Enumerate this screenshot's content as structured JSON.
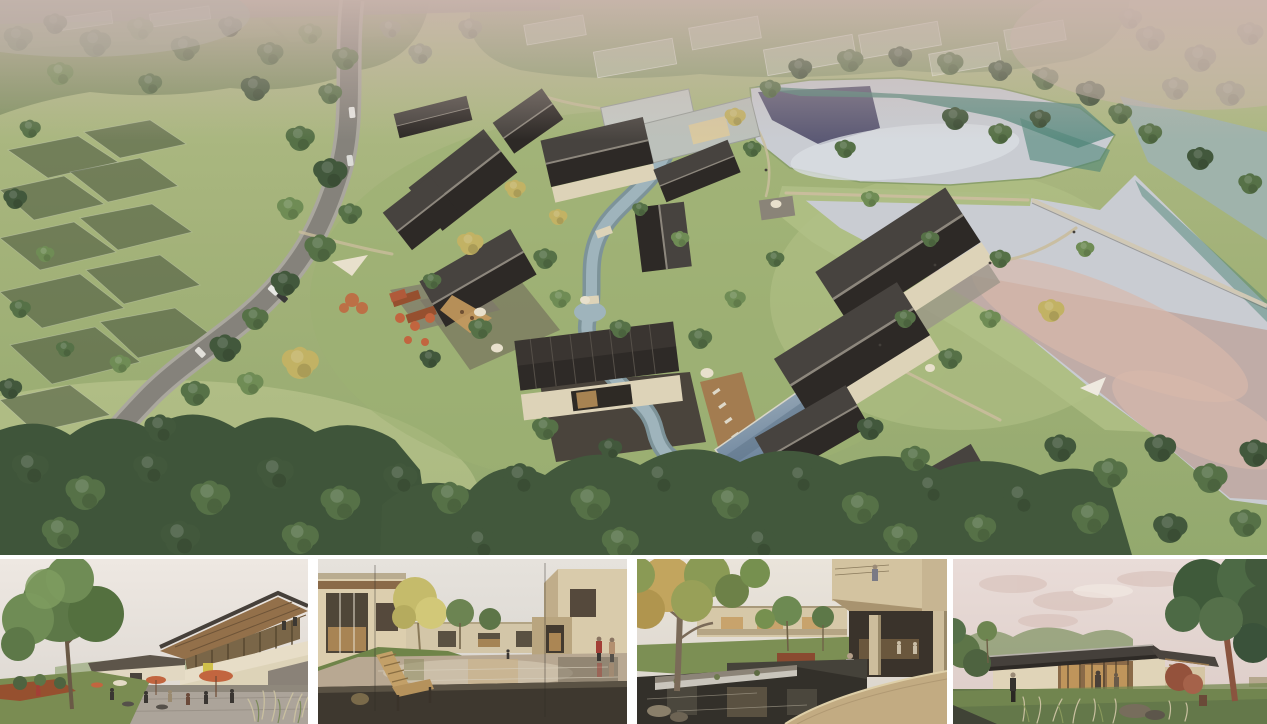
{
  "board": {
    "hero": {
      "name": "aerial-masterplan-view",
      "label": "Aerial rendering of a village resort masterplan: dark-roofed courtyard houses around a winding stream, country road and shaded orchards on the left, chain of fish ponds with walking dikes on the right"
    },
    "thumbnails": [
      {
        "name": "plaza-cafe-view",
        "label": "Eye-level rendering of a plaza cafe with orange umbrellas under a two-storey timber-soffit building and a large tree"
      },
      {
        "name": "reflecting-pond-view",
        "label": "Eye-level rendering of a courtyard reflecting pond with a wooden lounge bench and cream buildings"
      },
      {
        "name": "garden-waterfall-view",
        "label": "Eye-level rendering of a garden courtyard with dark pond, stone weir waterfall and cantilevered balcony"
      },
      {
        "name": "lakeside-pavilion-view",
        "label": "Eye-level dusk rendering of a single-storey glass pavilion with dark metal roof beside a large tree"
      }
    ],
    "palette": {
      "grassBase": "#a8b77d",
      "grassLight": "#c0ca96",
      "grassDark": "#7f9a5e",
      "lawn": "#9db36f",
      "treeDark": "#42583c",
      "treeMid": "#567147",
      "treeLight": "#6f8c55",
      "treeYellow": "#c2b264",
      "treeHazy": "#8a9579",
      "roofDark": "#3a3531",
      "roofLight": "#c3c7c2",
      "wallCream": "#ddd3b8",
      "road": "#85827b",
      "roadEdge": "#aaa79e",
      "waterSilver": "#c9ccd2",
      "waterTeal": "#4f8578",
      "waterNavy": "#413d5e",
      "waterMauve": "#bfa8a2",
      "waterPink": "#d8b9ab",
      "stream": "#9fb4bc",
      "pool": "#7e93a6",
      "deckWood": "#a37c50",
      "stonePaving": "#4a443c",
      "pathBeige": "#c9bd9c",
      "haze": "#cbb6ae",
      "netCanopy": "#3c4733",
      "skyWarm": "#ece6df",
      "skyDusk": "#e8dcd8",
      "cloudPink": "#d9c3bc",
      "umbrellaOrange": "#c2653f",
      "corten": "#96502f",
      "benchWood": "#c3a068",
      "pondCourt": "#b8a892",
      "pondDark": "#33302a",
      "weirWhite": "#d6d3c9",
      "stoneWarm": "#c2ab82",
      "glassGlow": "#c59a5e",
      "figureRed": "#a33f36",
      "figureTan": "#b39070",
      "trunk": "#7c6a55",
      "trunkRed": "#8a543f",
      "shrubRed": "#94523c",
      "grassTuft": "#c9c0a0"
    }
  }
}
